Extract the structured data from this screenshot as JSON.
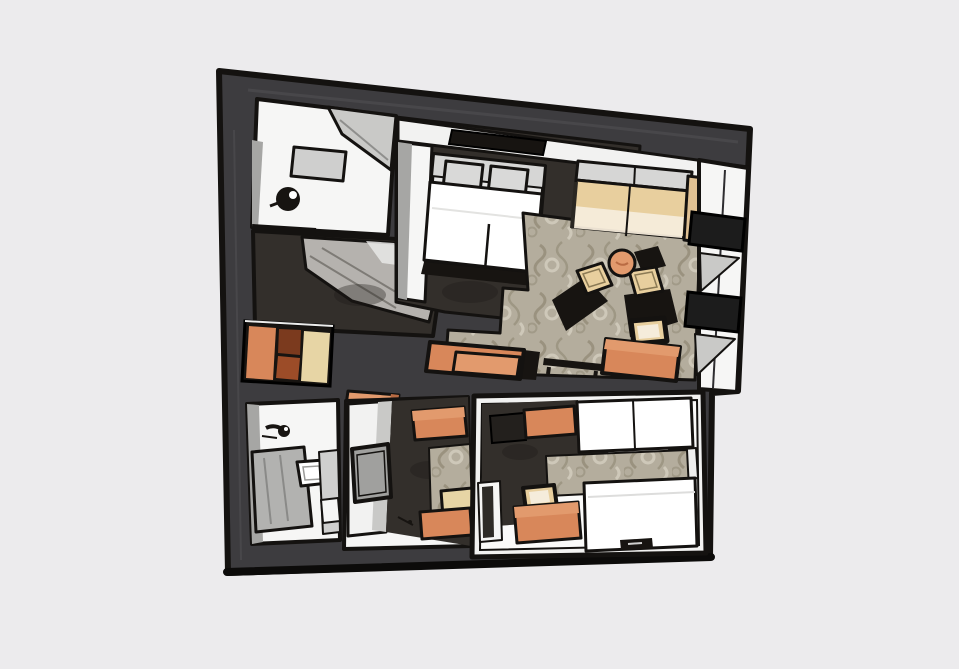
{
  "meta": {
    "kind": "floor-plan-illustration",
    "view": "top-down",
    "style": "hand-drawn stylized apartment suite plan on plain light-gray background"
  },
  "colors": {
    "background": "#ecebed",
    "wall": "#3d3c3f",
    "wall_light": "#4b4a4e",
    "outline": "#141210",
    "ink": "#171411",
    "floor_light": "#f6f6f5",
    "floor_dark": "#332f2b",
    "wall_face": "#a6a6a4",
    "shade": "#c9c9c7",
    "gray_box": "#cfcfce",
    "carpet": "#b4ad9d",
    "carpet_motif": "#958d7a",
    "carpet_light": "#cec8b9",
    "orange": "#d8875a",
    "orange_light": "#e29a6d",
    "orange_deep": "#b96b43",
    "tan": "#e8cf9e",
    "tan_light": "#f5ecdb",
    "cream": "#e7d5a5",
    "brown_dark": "#7b3a1e",
    "brown_mid": "#9c4c28",
    "white": "#ffffff",
    "pillow": "#d6d6d5"
  },
  "rooms": [
    {
      "name": "entry dressing room",
      "position": "upper left",
      "furniture": [
        "wardrobe wedge",
        "wall shelf",
        "floor lamp"
      ]
    },
    {
      "name": "closet nook",
      "position": "left of bedroom",
      "furniture": [
        "slanted wardrobe"
      ]
    },
    {
      "name": "master bedroom",
      "position": "top middle",
      "furniture": [
        "double bed",
        "two pillows",
        "tv niche",
        "closet column"
      ]
    },
    {
      "name": "living area",
      "position": "upper right",
      "furniture": [
        "sofa",
        "armchair",
        "armchair",
        "round coffee table",
        "luggage bench with chair",
        "twin chests",
        "low black table",
        "damask rug"
      ]
    },
    {
      "name": "side shelving ledge",
      "position": "right edge",
      "furniture": [
        "black wall box",
        "black wall box"
      ]
    },
    {
      "name": "storage cabinet",
      "position": "middle left wall",
      "furniture": [
        "orange door",
        "brown drawers",
        "cream door"
      ]
    },
    {
      "name": "bathroom",
      "position": "lower left",
      "furniture": [
        "faucet fixture",
        "vanity counter",
        "toilet",
        "side panel"
      ]
    },
    {
      "name": "dressing hallway",
      "position": "lower middle",
      "furniture": [
        "mirror panel",
        "wall shelf",
        "chest",
        "runner rug",
        "tan stool",
        "bench chest"
      ]
    },
    {
      "name": "second bedroom",
      "position": "lower right",
      "furniture": [
        "bed",
        "twin pillows",
        "nightstand",
        "rug",
        "wardrobe chest",
        "dark shelf",
        "desk chest",
        "tan chair",
        "media bar"
      ]
    }
  ]
}
